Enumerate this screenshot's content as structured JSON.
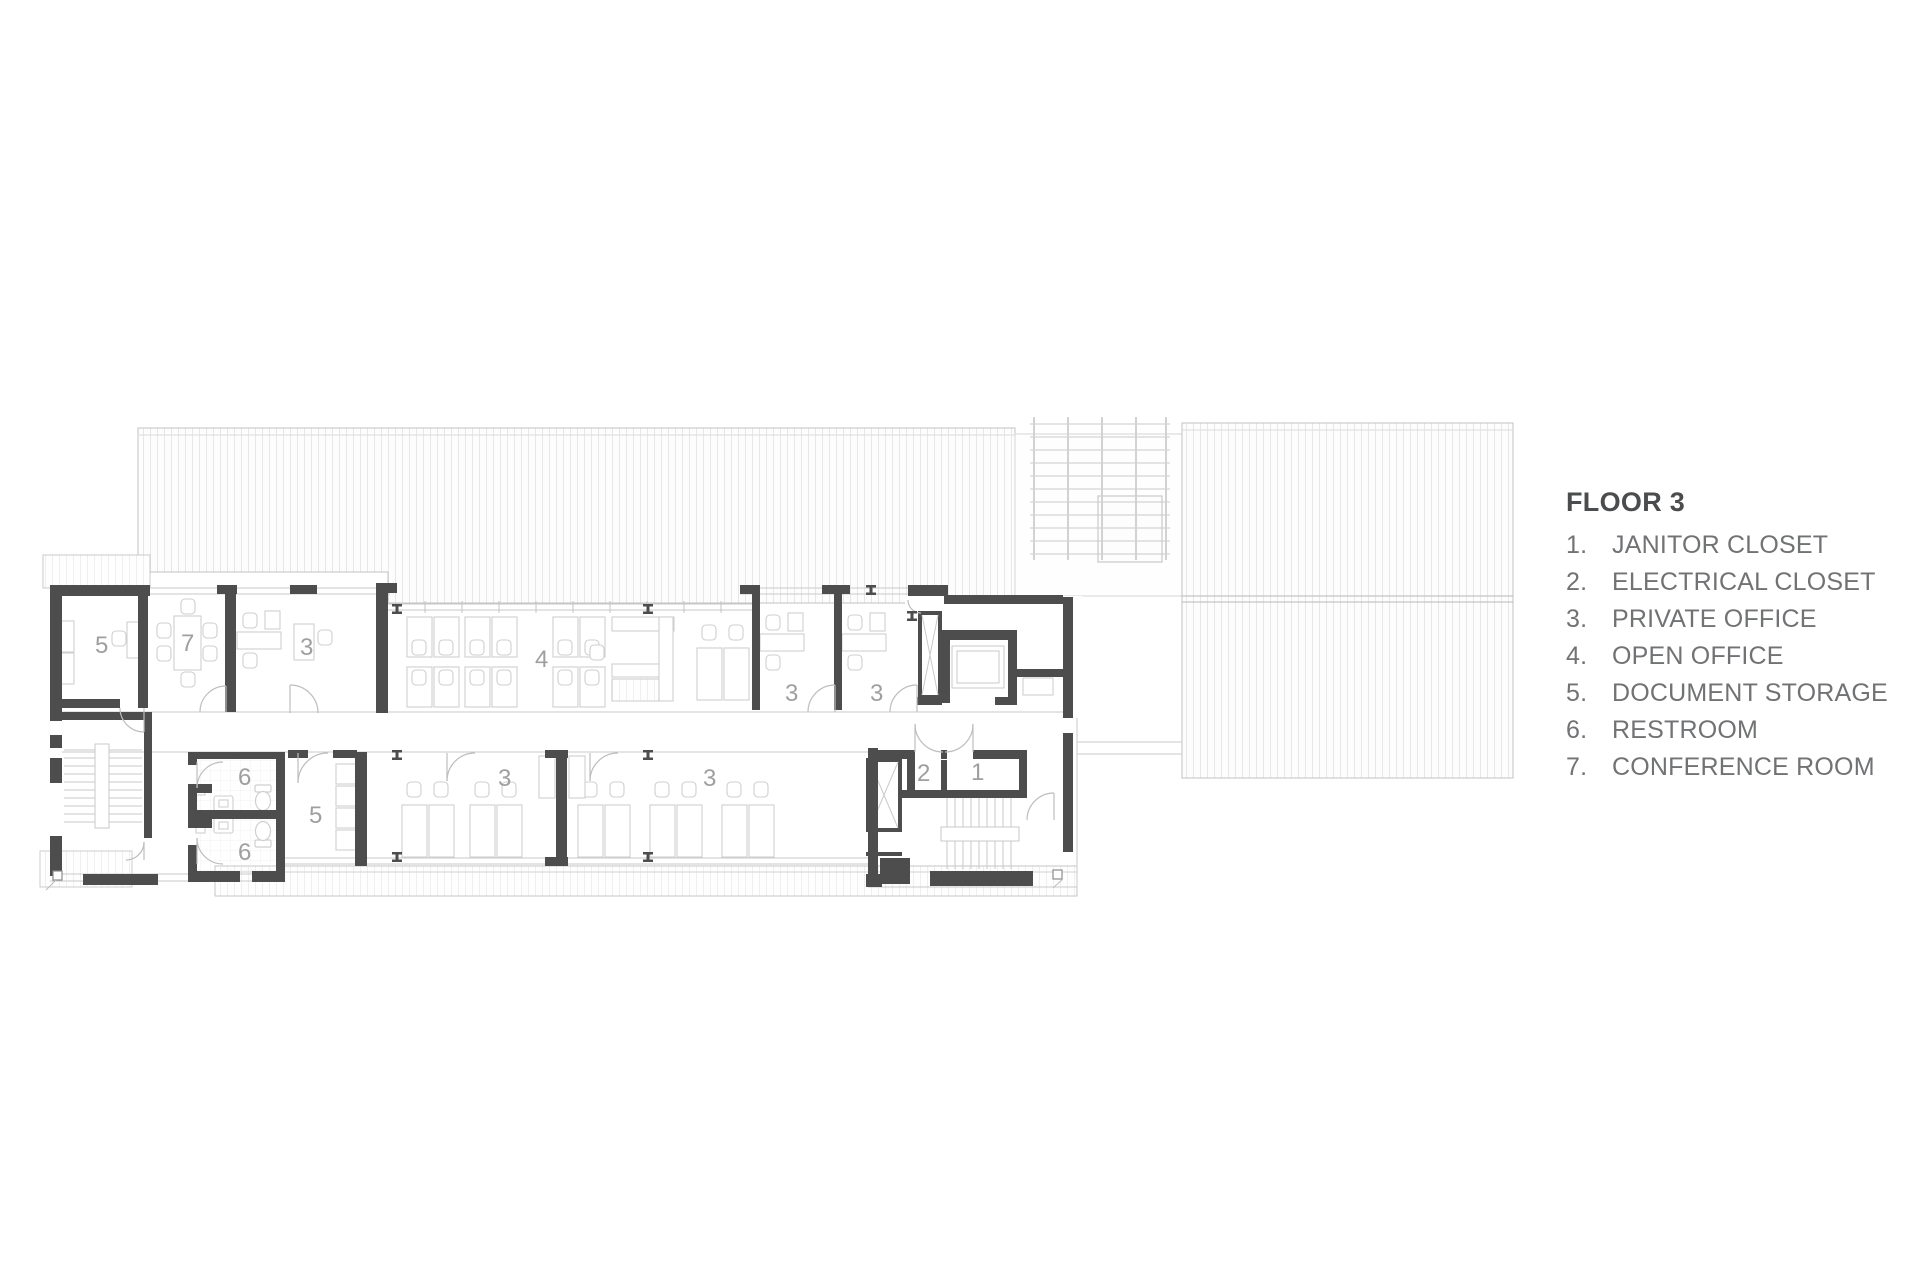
{
  "legend": {
    "title": "FLOOR 3",
    "items": [
      {
        "num": "1.",
        "label": "JANITOR CLOSET"
      },
      {
        "num": "2.",
        "label": "ELECTRICAL CLOSET"
      },
      {
        "num": "3.",
        "label": "PRIVATE OFFICE"
      },
      {
        "num": "4.",
        "label": "OPEN OFFICE"
      },
      {
        "num": "5.",
        "label": "DOCUMENT STORAGE"
      },
      {
        "num": "6.",
        "label": "RESTROOM"
      },
      {
        "num": "7.",
        "label": "CONFERENCE ROOM"
      }
    ]
  },
  "plan": {
    "room_labels": [
      {
        "room": "document-storage-upper",
        "text": "5"
      },
      {
        "room": "conference-room",
        "text": "7"
      },
      {
        "room": "private-office-upper-1",
        "text": "3"
      },
      {
        "room": "open-office",
        "text": "4"
      },
      {
        "room": "private-office-upper-2",
        "text": "3"
      },
      {
        "room": "private-office-upper-3",
        "text": "3"
      },
      {
        "room": "restroom-upper",
        "text": "6"
      },
      {
        "room": "document-storage-lower",
        "text": "5"
      },
      {
        "room": "restroom-lower",
        "text": "6"
      },
      {
        "room": "private-office-lower-1",
        "text": "3"
      },
      {
        "room": "private-office-lower-2",
        "text": "3"
      },
      {
        "room": "electrical-closet",
        "text": "2"
      },
      {
        "room": "janitor-closet",
        "text": "1"
      }
    ],
    "colors": {
      "wall": "#4d4d4d",
      "line": "#c9c9c9",
      "roofb": "#c2c2c2",
      "label": "#9f9f9f",
      "legend-title": "#4b4c4e",
      "legend-text": "#717274"
    }
  }
}
